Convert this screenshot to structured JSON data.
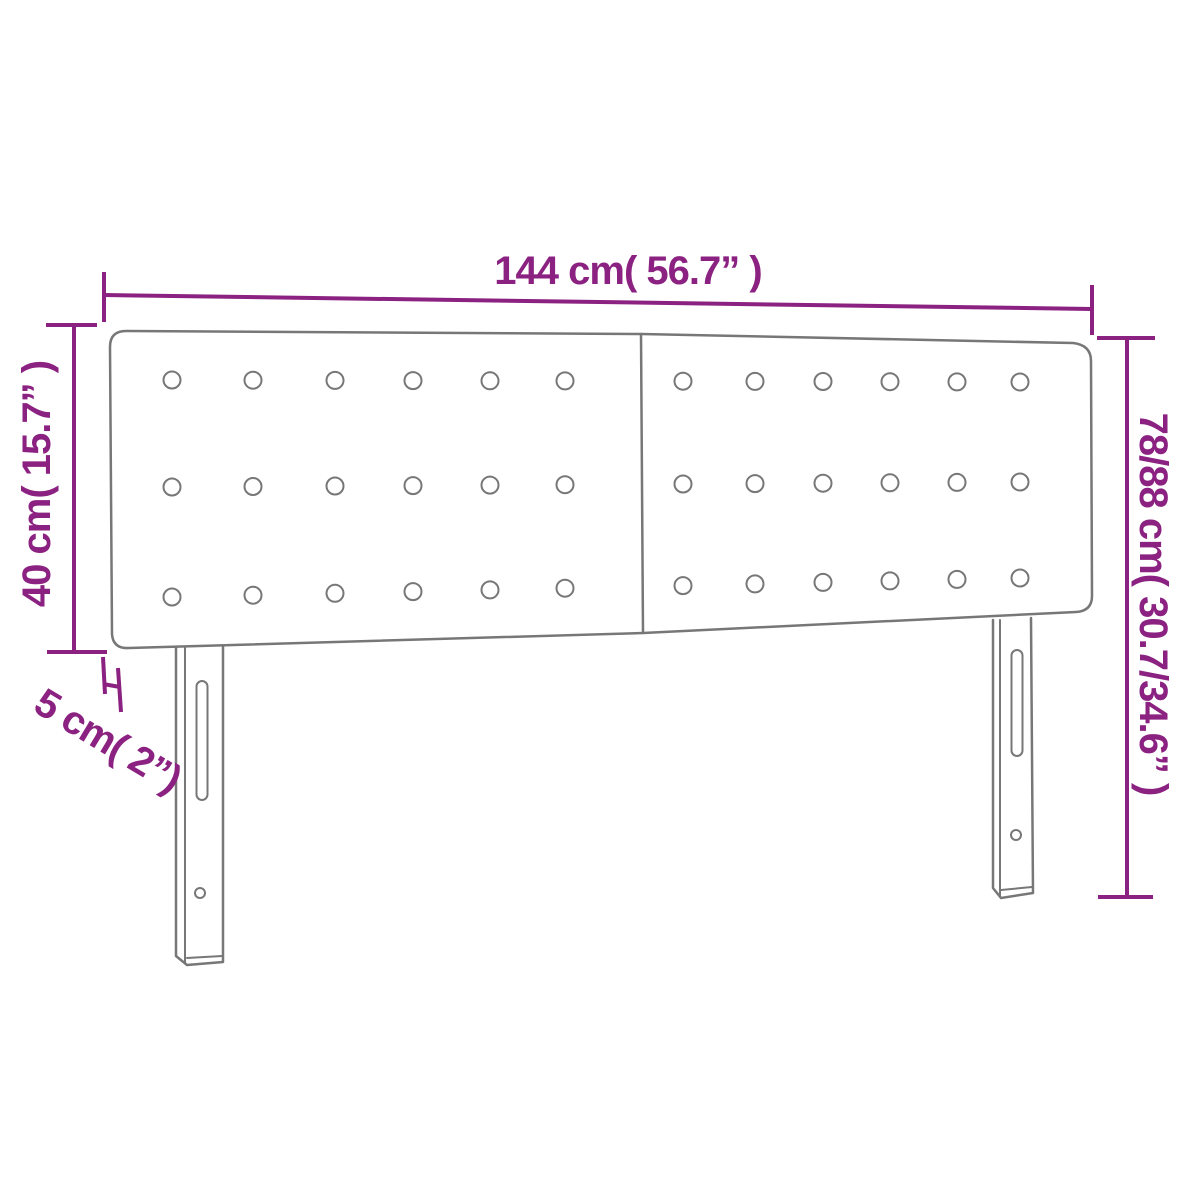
{
  "diagram": {
    "name": "headboard-dimension-diagram",
    "background": "#ffffff",
    "line_color": "#777777",
    "dimension_color": "#8B2180",
    "labels": {
      "width": "144 cm( 56.7” )",
      "panel_height": "40 cm( 15.7” )",
      "thickness": "5 cm( 2”)",
      "total_height": "78/88 cm( 30.7/34.6” )"
    },
    "tufting": {
      "rows": 3,
      "columns": 12
    }
  }
}
